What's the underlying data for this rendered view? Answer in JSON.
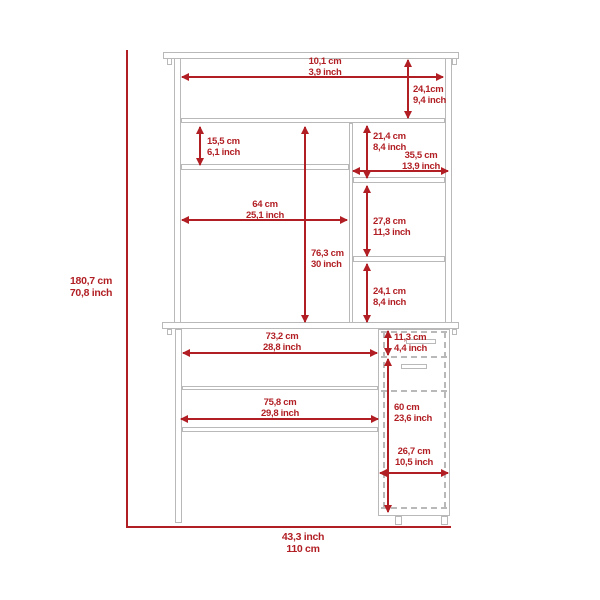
{
  "colors": {
    "accent": "#b11f24",
    "line": "#b9b9b9"
  },
  "overall": {
    "height": {
      "line1": "180,7 cm",
      "line2": "70,8 inch"
    },
    "width": {
      "line1": "43,3 inch",
      "line2": "110 cm"
    }
  },
  "dims": {
    "top_depth": {
      "line1": "10,1 cm",
      "line2": "3,9 inch"
    },
    "hutch_top_height": {
      "line1": "24,1cm",
      "line2": "9,4 inch"
    },
    "left_cubby": {
      "line1": "15,5 cm",
      "line2": "6,1 inch"
    },
    "right_cubby": {
      "line1": "21,4 cm",
      "line2": "8,4 inch"
    },
    "right_width": {
      "line1": "35,5 cm",
      "line2": "13,9 inch"
    },
    "left_width": {
      "line1": "64 cm",
      "line2": "25,1 inch"
    },
    "hutch_height": {
      "line1": "76,3 cm",
      "line2": "30 inch"
    },
    "right_mid": {
      "line1": "27,8 cm",
      "line2": "11,3 inch"
    },
    "right_low": {
      "line1": "24,1 cm",
      "line2": "8,4 inch"
    },
    "desktop_width": {
      "line1": "73,2 cm",
      "line2": "28,8 inch"
    },
    "drawer_height": {
      "line1": "11,3 cm",
      "line2": "4,4 inch"
    },
    "shelf_width": {
      "line1": "75,8 cm",
      "line2": "29,8 inch"
    },
    "pedestal_height": {
      "line1": "60 cm",
      "line2": "23,6 inch"
    },
    "pedestal_width": {
      "line1": "26,7 cm",
      "line2": "10,5 inch"
    }
  }
}
